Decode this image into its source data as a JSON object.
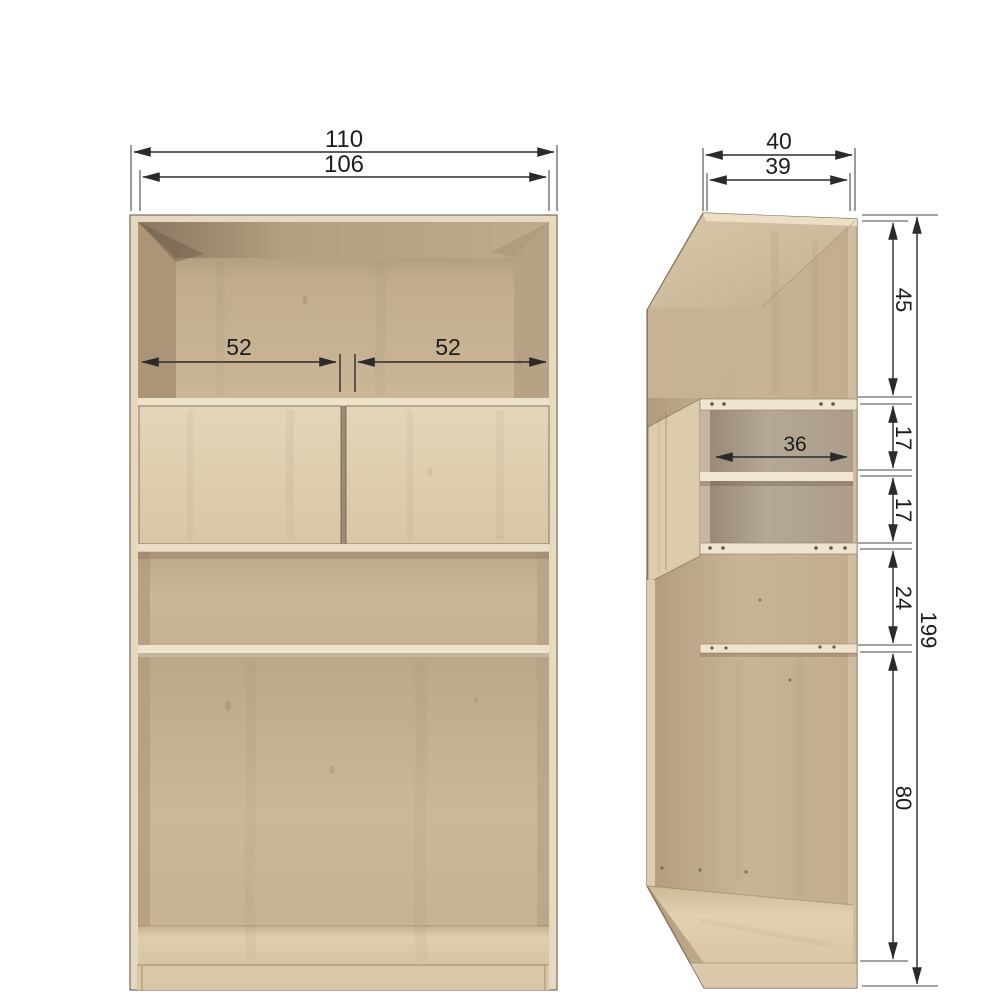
{
  "dims": {
    "front_outer_width": "110",
    "front_inner_width": "106",
    "front_left_compartment": "52",
    "front_right_compartment": "52",
    "side_outer_depth": "40",
    "side_inner_depth": "39",
    "side_shelf_depth": "36",
    "side_top_section": "45",
    "side_door_upper": "17",
    "side_door_lower": "17",
    "side_middle_section": "24",
    "side_bottom_section": "80",
    "side_total_height": "199"
  },
  "colors": {
    "background": "#ffffff",
    "dimension_line": "#2b2b2b",
    "label_text": "#1d1d1d",
    "wood_frame": "#e7d9bf",
    "wood_interior": "#c9b496",
    "wood_interior_dark": "#a08a70",
    "wood_door": "#e0d0b4",
    "box_interior": "#b3a694",
    "shelf_edge": "#efe5cf",
    "floor_pine": "#ddcba9"
  }
}
